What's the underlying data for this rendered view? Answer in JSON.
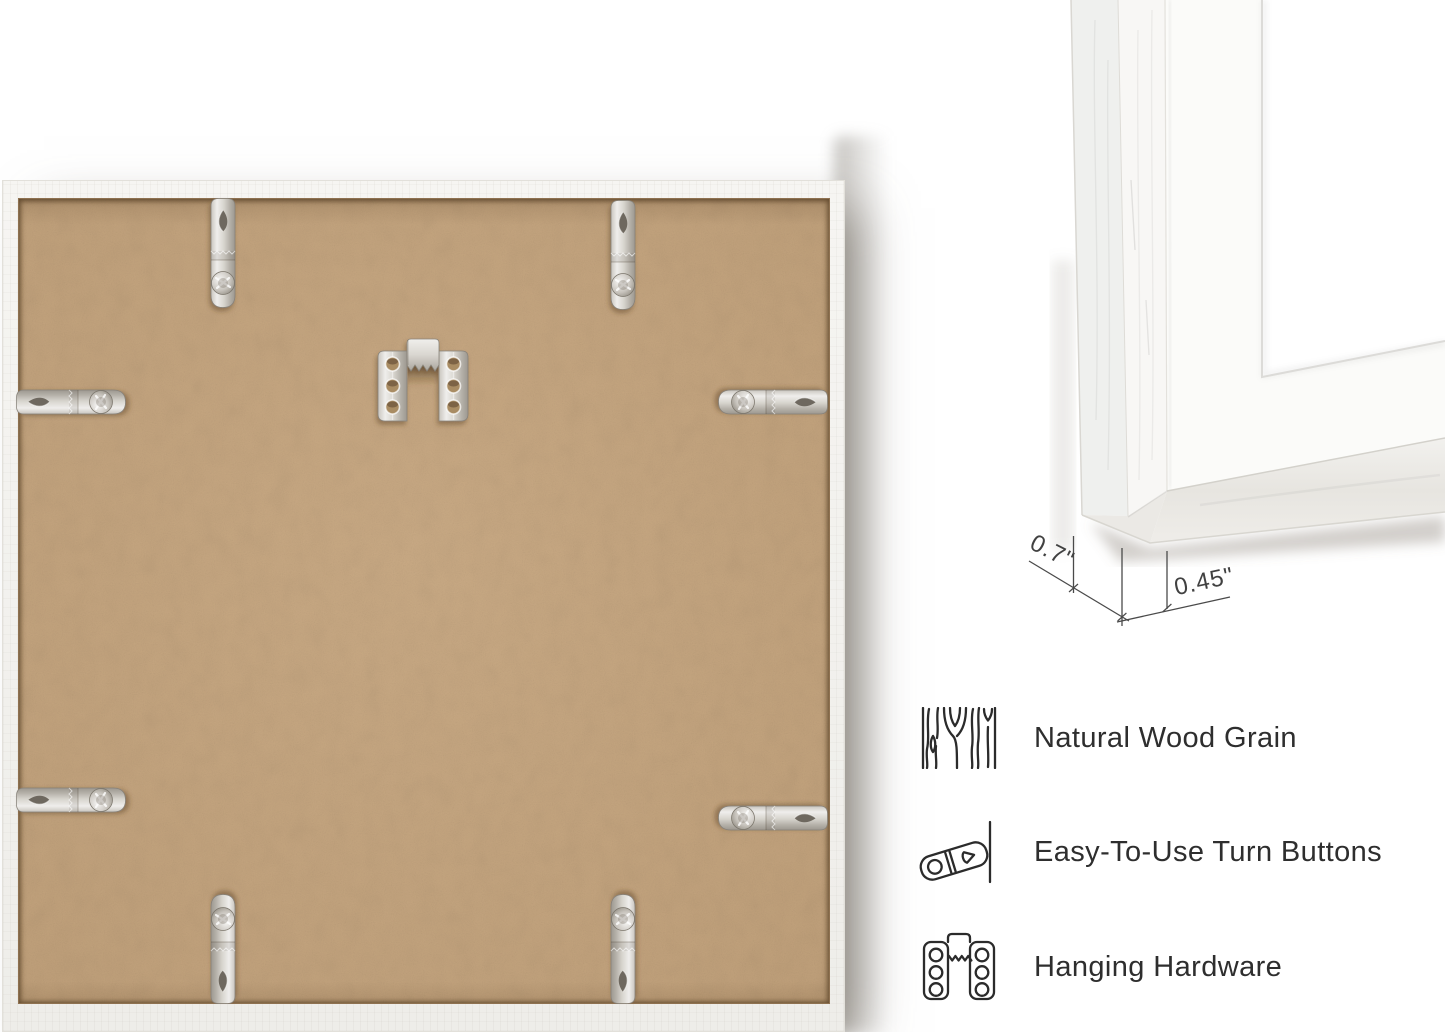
{
  "dimensions": {
    "depth_label": "0.7\"",
    "face_label": "0.45\""
  },
  "features": [
    {
      "icon": "wood-grain-icon",
      "label": "Natural Wood Grain"
    },
    {
      "icon": "turn-button-icon",
      "label": "Easy-To-Use Turn Buttons"
    },
    {
      "icon": "hanging-hardware-icon",
      "label": "Hanging Hardware"
    }
  ],
  "hardware": {
    "turn_button_count": 8,
    "sawtooth_hanger_count": 1
  },
  "colors": {
    "background": "#ffffff",
    "mdf_backing": "#c7a67e",
    "frame_white": "#f4f3f0",
    "metal": "#cdc9c2",
    "feature_text": "#2e2e2e",
    "dimension_text": "#414141"
  }
}
